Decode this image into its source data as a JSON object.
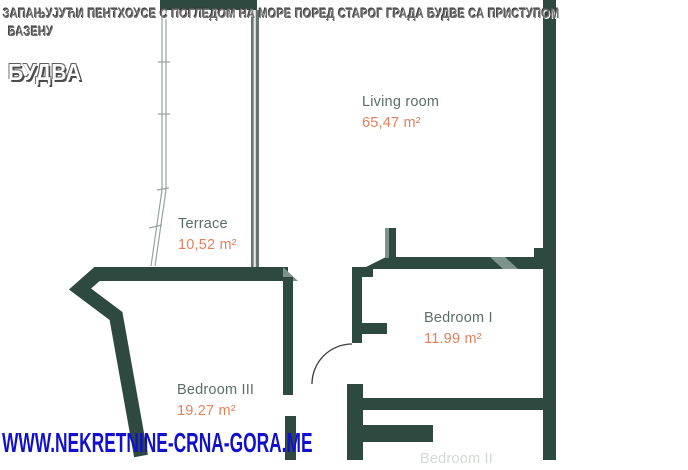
{
  "header": {
    "title_line1": "ЗАПАЊУЈУЋИ ПЕНТХОУСЕ С ПОГЛЕДОМ НА МОРЕ ПОРЕД СТАРОГ ГРАДА БУДВЕ СА ПРИСТУПОМ",
    "title_line2": "БАЗЕНУ",
    "city": "БУДВА"
  },
  "floorplan": {
    "rooms": [
      {
        "name": "Living room",
        "area": "65,47 m²"
      },
      {
        "name": "Terrace",
        "area": "10,52 m²"
      },
      {
        "name": "Bedroom I",
        "area": "11.99 m²"
      },
      {
        "name": "Bedroom III",
        "area": "19.27 m²"
      },
      {
        "name": "Bedroom II",
        "area": ""
      }
    ]
  },
  "watermark": "WWW.NEKRETNINE-CRNA-GORA.ME",
  "colors": {
    "wall": "#2e4a40",
    "wall_light": "#7e938c",
    "window_line": "#98a39d",
    "room_label": "#5d6e69",
    "area_value": "#e0815e",
    "watermark_blue": "#1111cd"
  }
}
